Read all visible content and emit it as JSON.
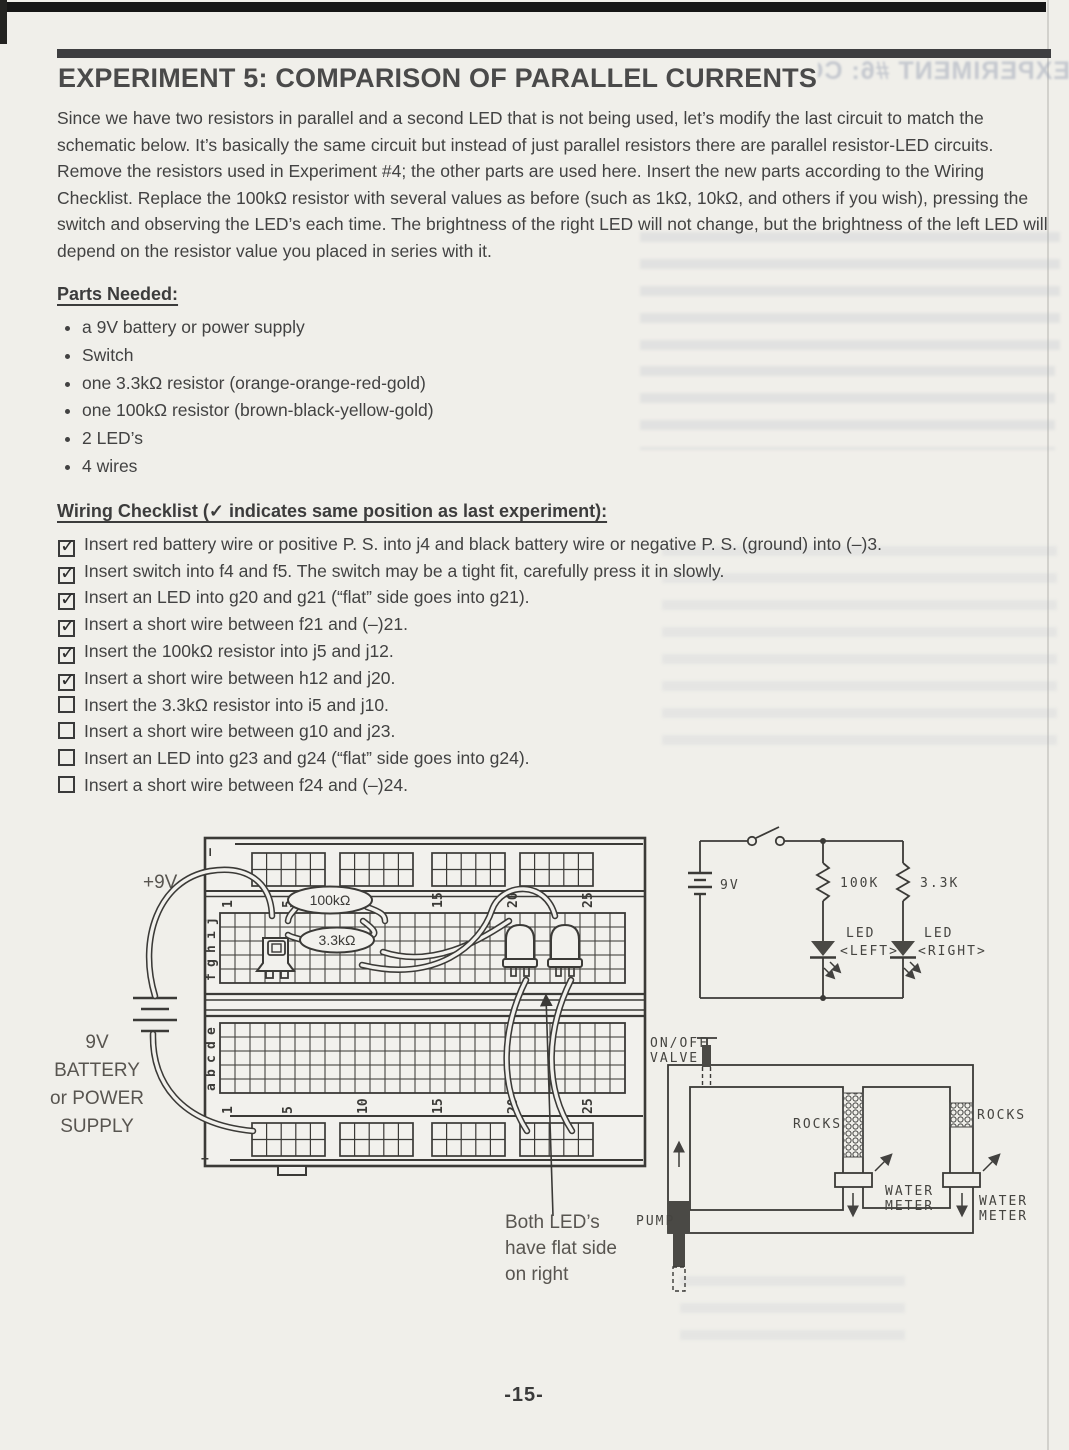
{
  "page": {
    "title": "EXPERIMENT 5:  COMPARISON OF PARALLEL CURRENTS",
    "intro_paragraph": "Since we have two resistors in parallel and a second LED that is not being used, let’s modify the last circuit to match the schematic below.  It’s basically the same circuit but instead of just parallel resistors there are parallel resistor-LED circuits.  Remove the resistors used in Experiment #4; the other parts are used here.  Insert the new parts according to the Wiring Checklist.  Replace the 100kΩ resistor with several values as before (such as 1kΩ, 10kΩ, and others if you wish), pressing the switch and observing the LED’s each time.  The brightness of the right LED will not change, but the brightness of the left LED will depend on the resistor value you placed in series with it.",
    "page_number": "-15-"
  },
  "parts_needed": {
    "heading": "Parts Needed:",
    "items": [
      "a 9V battery or power supply",
      "Switch",
      "one 3.3kΩ resistor (orange-orange-red-gold)",
      "one 100kΩ resistor (brown-black-yellow-gold)",
      "2 LED’s",
      "4 wires"
    ]
  },
  "wiring_checklist": {
    "heading": "Wiring Checklist (✓ indicates same position as last experiment):",
    "items": [
      {
        "checked": true,
        "text": "Insert red battery wire or positive P. S. into j4 and black battery wire or negative P. S. (ground) into (–)3."
      },
      {
        "checked": true,
        "text": "Insert switch into f4 and f5.  The switch may be a tight fit, carefully press it in slowly."
      },
      {
        "checked": true,
        "text": "Insert an LED into g20 and g21 (“flat” side goes into g21)."
      },
      {
        "checked": true,
        "text": "Insert a short wire between f21 and (–)21."
      },
      {
        "checked": true,
        "text": "Insert the 100kΩ resistor into j5 and j12."
      },
      {
        "checked": true,
        "text": "Insert a short wire between h12 and j20."
      },
      {
        "checked": false,
        "text": "Insert the 3.3kΩ resistor into i5 and j10."
      },
      {
        "checked": false,
        "text": "Insert a short wire between g10 and j23."
      },
      {
        "checked": false,
        "text": "Insert an LED into g23 and g24 (“flat” side goes into g24)."
      },
      {
        "checked": false,
        "text": "Insert a short wire between f24 and (–)24."
      }
    ]
  },
  "breadboard": {
    "plus9v_label": "+9V",
    "battery_caption_lines": [
      "9V",
      "BATTERY",
      "or POWER",
      "SUPPLY"
    ],
    "resistor1_label": "100kΩ",
    "resistor2_label": "3.3kΩ",
    "row_letters_top": [
      "j",
      "i",
      "h",
      "g",
      "f"
    ],
    "row_letters_bottom": [
      "e",
      "d",
      "c",
      "b",
      "a"
    ],
    "column_numbers": [
      "1",
      "5",
      "10",
      "15",
      "20",
      "25"
    ],
    "minus_label_top": "–",
    "minus_label_bottom": "–",
    "plus_label": "+",
    "callout_lines": [
      "Both LED’s",
      "have flat side",
      "on right"
    ]
  },
  "schematic": {
    "battery_label": "9V",
    "resistor_left_label": "100K",
    "resistor_right_label": "3.3K",
    "led_left_label_line1": "LED",
    "led_left_label_line2": "<LEFT>",
    "led_right_label_line1": "LED",
    "led_right_label_line2": "<RIGHT>"
  },
  "water_diagram": {
    "valve_label_line1": "ON/OFF",
    "valve_label_line2": "VALVE",
    "rocks_left_label": "ROCKS",
    "rocks_right_label": "ROCKS",
    "meter1_label_line1": "WATER",
    "meter1_label_line2": "METER",
    "meter2_label_line1": "WATER",
    "meter2_label_line2": "METER",
    "pump_label": "PUMP"
  },
  "icons": {
    "checkmark": "✓"
  },
  "bleedthrough": {
    "title_fragment": "EXPERIMENT #6: CO"
  }
}
